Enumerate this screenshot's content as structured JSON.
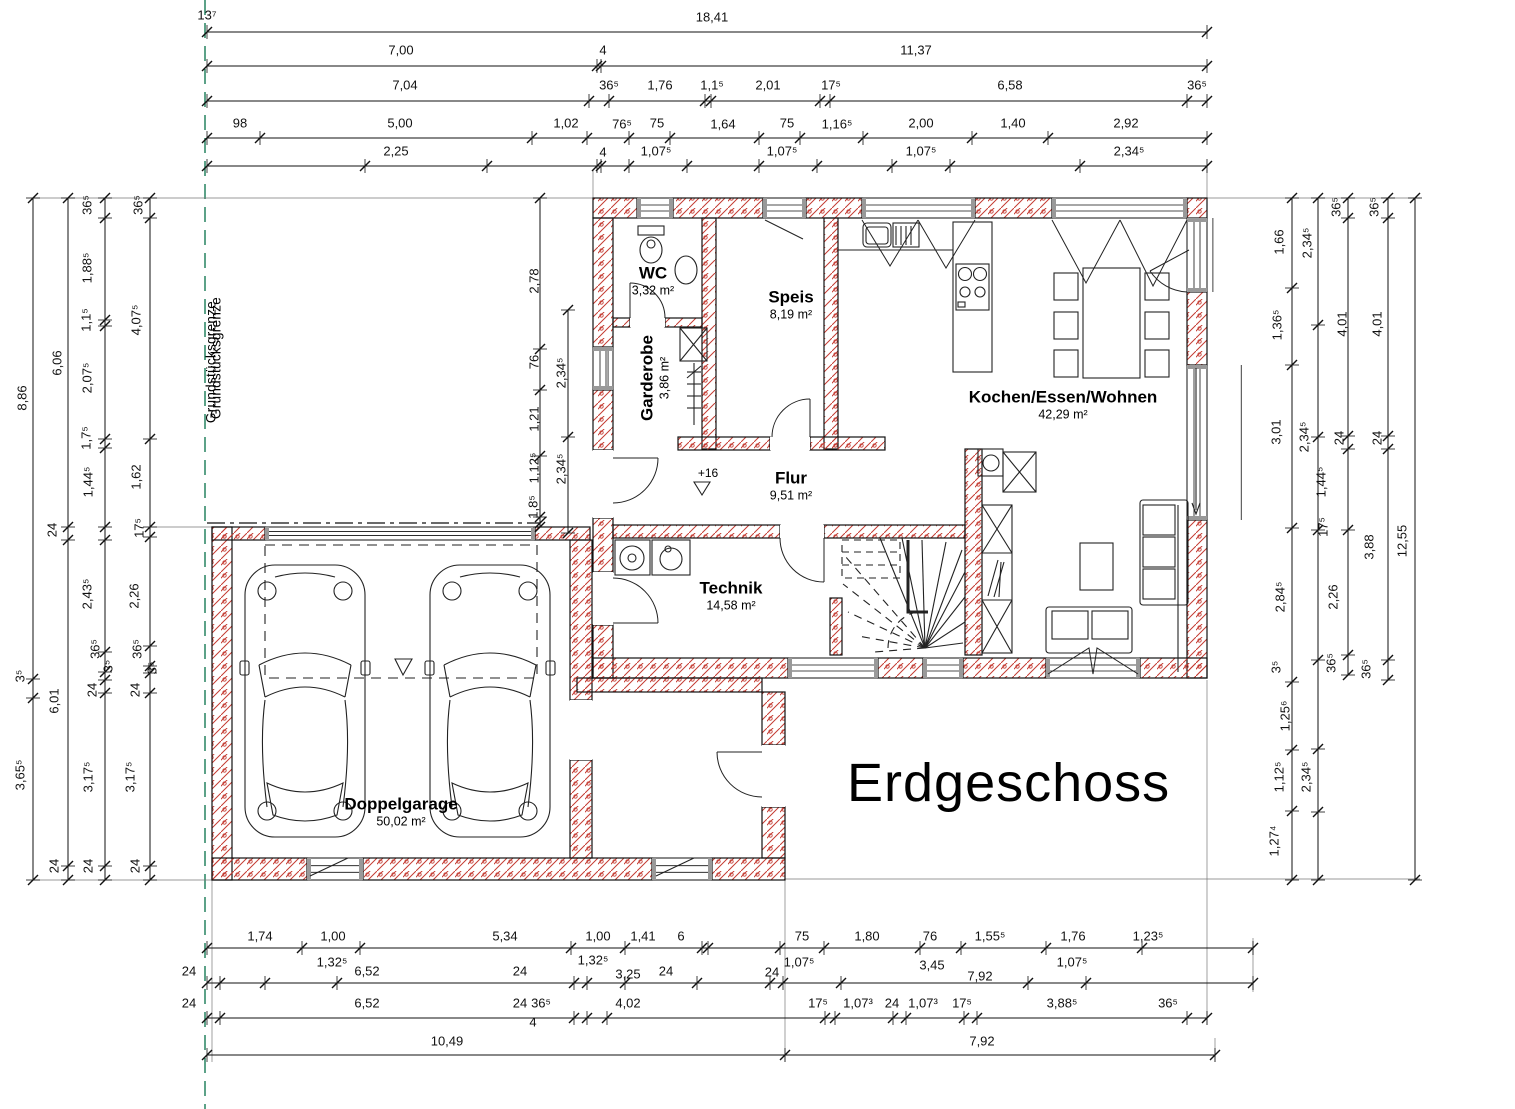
{
  "title": "Erdgeschoss",
  "property_boundary_label": "Grundstücksgrenze",
  "level_marker": "+16",
  "colors": {
    "wall_hatch": "#c43c33",
    "boundary_line": "#177a55",
    "line": "#111111"
  },
  "rooms": [
    {
      "name": "WC",
      "area": "3,32 m²",
      "x": 653,
      "y": 281,
      "rot": false
    },
    {
      "name": "Speis",
      "area": "8,19 m²",
      "x": 791,
      "y": 305,
      "rot": false
    },
    {
      "name": "Garderobe",
      "area": "3,86 m²",
      "x": 655,
      "y": 378,
      "rot": true
    },
    {
      "name": "Kochen/Essen/Wohnen",
      "area": "42,29 m²",
      "x": 1063,
      "y": 405,
      "rot": false
    },
    {
      "name": "Flur",
      "area": "9,51 m²",
      "x": 791,
      "y": 486,
      "rot": false
    },
    {
      "name": "Technik",
      "area": "14,58 m²",
      "x": 731,
      "y": 596,
      "rot": false
    },
    {
      "name": "Doppelgarage",
      "area": "50,02 m²",
      "x": 401,
      "y": 812,
      "rot": false
    }
  ],
  "dimensions": {
    "top": [
      {
        "t": "13⁷",
        "x": 207,
        "y": 15
      },
      {
        "t": "18,41",
        "x": 712,
        "y": 17
      },
      {
        "t": "7,00",
        "x": 401,
        "y": 50
      },
      {
        "t": "4",
        "x": 603,
        "y": 50
      },
      {
        "t": "11,37",
        "x": 916,
        "y": 50
      },
      {
        "t": "7,04",
        "x": 405,
        "y": 85
      },
      {
        "t": "36⁵",
        "x": 609,
        "y": 85
      },
      {
        "t": "1,76",
        "x": 660,
        "y": 85
      },
      {
        "t": "1,1⁵",
        "x": 712,
        "y": 85
      },
      {
        "t": "2,01",
        "x": 768,
        "y": 85
      },
      {
        "t": "17⁵",
        "x": 831,
        "y": 85
      },
      {
        "t": "6,58",
        "x": 1010,
        "y": 85
      },
      {
        "t": "36⁵",
        "x": 1197,
        "y": 85
      },
      {
        "t": "98",
        "x": 240,
        "y": 123
      },
      {
        "t": "5,00",
        "x": 400,
        "y": 123
      },
      {
        "t": "1,02",
        "x": 566,
        "y": 123
      },
      {
        "t": "76⁵",
        "x": 622,
        "y": 124
      },
      {
        "t": "75",
        "x": 657,
        "y": 123
      },
      {
        "t": "1,64",
        "x": 723,
        "y": 124
      },
      {
        "t": "75",
        "x": 787,
        "y": 123
      },
      {
        "t": "1,16⁵",
        "x": 837,
        "y": 124
      },
      {
        "t": "2,00",
        "x": 921,
        "y": 123
      },
      {
        "t": "1,40",
        "x": 1013,
        "y": 123
      },
      {
        "t": "2,92",
        "x": 1126,
        "y": 123
      },
      {
        "t": "2,25",
        "x": 396,
        "y": 151
      },
      {
        "t": "4",
        "x": 603,
        "y": 152
      },
      {
        "t": "1,07⁵",
        "x": 656,
        "y": 151
      },
      {
        "t": "1,07⁵",
        "x": 782,
        "y": 151
      },
      {
        "t": "1,07⁵",
        "x": 921,
        "y": 151
      },
      {
        "t": "2,34⁵",
        "x": 1129,
        "y": 151
      }
    ],
    "bottom": [
      {
        "t": "1,74",
        "x": 260,
        "y": 936
      },
      {
        "t": "1,00",
        "x": 333,
        "y": 936
      },
      {
        "t": "5,34",
        "x": 505,
        "y": 936
      },
      {
        "t": "1,00",
        "x": 598,
        "y": 936
      },
      {
        "t": "1,41",
        "x": 643,
        "y": 936
      },
      {
        "t": "6",
        "x": 681,
        "y": 936
      },
      {
        "t": "75",
        "x": 802,
        "y": 936
      },
      {
        "t": "1,80",
        "x": 867,
        "y": 936
      },
      {
        "t": "76",
        "x": 930,
        "y": 936
      },
      {
        "t": "1,55⁵",
        "x": 990,
        "y": 936
      },
      {
        "t": "1,76",
        "x": 1073,
        "y": 936
      },
      {
        "t": "1,23⁵",
        "x": 1148,
        "y": 936
      },
      {
        "t": "24",
        "x": 189,
        "y": 971
      },
      {
        "t": "1,32⁵",
        "x": 332,
        "y": 962
      },
      {
        "t": "6,52",
        "x": 367,
        "y": 971
      },
      {
        "t": "24",
        "x": 520,
        "y": 971
      },
      {
        "t": "1,32⁵",
        "x": 593,
        "y": 960
      },
      {
        "t": "3,25",
        "x": 628,
        "y": 974
      },
      {
        "t": "24",
        "x": 666,
        "y": 971
      },
      {
        "t": "24",
        "x": 772,
        "y": 972
      },
      {
        "t": "1,07⁵",
        "x": 799,
        "y": 962
      },
      {
        "t": "3,45",
        "x": 932,
        "y": 965
      },
      {
        "t": "7,92",
        "x": 980,
        "y": 976
      },
      {
        "t": "1,07⁵",
        "x": 1072,
        "y": 962
      },
      {
        "t": "24",
        "x": 189,
        "y": 1003
      },
      {
        "t": "6,52",
        "x": 367,
        "y": 1003
      },
      {
        "t": "24",
        "x": 520,
        "y": 1003
      },
      {
        "t": "36⁵",
        "x": 541,
        "y": 1003
      },
      {
        "t": "4",
        "x": 533,
        "y": 1022
      },
      {
        "t": "4,02",
        "x": 628,
        "y": 1003
      },
      {
        "t": "17⁵",
        "x": 818,
        "y": 1003
      },
      {
        "t": "1,07³",
        "x": 858,
        "y": 1003
      },
      {
        "t": "24",
        "x": 892,
        "y": 1003
      },
      {
        "t": "1,07³",
        "x": 923,
        "y": 1003
      },
      {
        "t": "17⁵",
        "x": 962,
        "y": 1003
      },
      {
        "t": "3,88⁵",
        "x": 1062,
        "y": 1003
      },
      {
        "t": "36⁵",
        "x": 1168,
        "y": 1003
      },
      {
        "t": "10,49",
        "x": 447,
        "y": 1041
      },
      {
        "t": "7,92",
        "x": 982,
        "y": 1041
      }
    ],
    "left": [
      {
        "t": "8,86",
        "x": 22,
        "y": 398
      },
      {
        "t": "3⁵",
        "x": 20,
        "y": 676
      },
      {
        "t": "3,65⁵",
        "x": 20,
        "y": 775
      },
      {
        "t": "6,06",
        "x": 57,
        "y": 363
      },
      {
        "t": "24",
        "x": 52,
        "y": 530
      },
      {
        "t": "6,01",
        "x": 54,
        "y": 701
      },
      {
        "t": "24",
        "x": 54,
        "y": 866
      },
      {
        "t": "36⁵",
        "x": 87,
        "y": 205
      },
      {
        "t": "1,88⁵",
        "x": 87,
        "y": 268
      },
      {
        "t": "1,1⁵",
        "x": 86,
        "y": 320
      },
      {
        "t": "2,07⁵",
        "x": 87,
        "y": 378
      },
      {
        "t": "1,7⁵",
        "x": 86,
        "y": 438
      },
      {
        "t": "1,44⁵",
        "x": 88,
        "y": 482
      },
      {
        "t": "2,43⁵",
        "x": 87,
        "y": 594
      },
      {
        "t": "36⁵",
        "x": 95,
        "y": 649
      },
      {
        "t": "3⁵",
        "x": 108,
        "y": 666
      },
      {
        "t": "24",
        "x": 92,
        "y": 690
      },
      {
        "t": "3,17⁵",
        "x": 88,
        "y": 777
      },
      {
        "t": "24",
        "x": 88,
        "y": 866
      },
      {
        "t": "36⁵",
        "x": 138,
        "y": 205
      },
      {
        "t": "4,07⁵",
        "x": 136,
        "y": 320
      },
      {
        "t": "1,62",
        "x": 136,
        "y": 477
      },
      {
        "t": "17⁵",
        "x": 139,
        "y": 528
      },
      {
        "t": "2,26",
        "x": 134,
        "y": 596
      },
      {
        "t": "36⁵",
        "x": 137,
        "y": 649
      },
      {
        "t": "3⁵",
        "x": 152,
        "y": 668
      },
      {
        "t": "24",
        "x": 135,
        "y": 690
      },
      {
        "t": "3,17⁵",
        "x": 130,
        "y": 777
      },
      {
        "t": "24",
        "x": 135,
        "y": 866
      }
    ],
    "right": [
      {
        "t": "1,66",
        "x": 1279,
        "y": 242
      },
      {
        "t": "1,36⁵",
        "x": 1277,
        "y": 325
      },
      {
        "t": "3,01",
        "x": 1276,
        "y": 432
      },
      {
        "t": "2,84⁵",
        "x": 1280,
        "y": 597
      },
      {
        "t": "3⁵",
        "x": 1276,
        "y": 667
      },
      {
        "t": "1,25⁶",
        "x": 1285,
        "y": 716
      },
      {
        "t": "1,12⁵",
        "x": 1279,
        "y": 777
      },
      {
        "t": "1,27⁴",
        "x": 1274,
        "y": 841
      },
      {
        "t": "2,34⁵",
        "x": 1307,
        "y": 243
      },
      {
        "t": "2,34⁵",
        "x": 1304,
        "y": 437
      },
      {
        "t": "1,44⁵",
        "x": 1321,
        "y": 482
      },
      {
        "t": "17⁵",
        "x": 1323,
        "y": 527
      },
      {
        "t": "2,34⁵",
        "x": 1306,
        "y": 777
      },
      {
        "t": "36⁵",
        "x": 1336,
        "y": 207
      },
      {
        "t": "4,01",
        "x": 1342,
        "y": 324
      },
      {
        "t": "24",
        "x": 1339,
        "y": 438
      },
      {
        "t": "2,26",
        "x": 1333,
        "y": 597
      },
      {
        "t": "36⁵",
        "x": 1331,
        "y": 663
      },
      {
        "t": "36⁵",
        "x": 1374,
        "y": 207
      },
      {
        "t": "4,01",
        "x": 1377,
        "y": 324
      },
      {
        "t": "24",
        "x": 1377,
        "y": 438
      },
      {
        "t": "3,88",
        "x": 1369,
        "y": 547
      },
      {
        "t": "36⁵",
        "x": 1366,
        "y": 669
      },
      {
        "t": "12,55",
        "x": 1402,
        "y": 541
      }
    ],
    "interior": [
      {
        "t": "2,78",
        "x": 534,
        "y": 281
      },
      {
        "t": "76",
        "x": 534,
        "y": 362
      },
      {
        "t": "1,21",
        "x": 534,
        "y": 419
      },
      {
        "t": "1,12⁵",
        "x": 534,
        "y": 468
      },
      {
        "t": "1,8⁵",
        "x": 533,
        "y": 507
      },
      {
        "t": "2,34⁵",
        "x": 561,
        "y": 373
      },
      {
        "t": "2,34⁵",
        "x": 561,
        "y": 469
      }
    ]
  }
}
